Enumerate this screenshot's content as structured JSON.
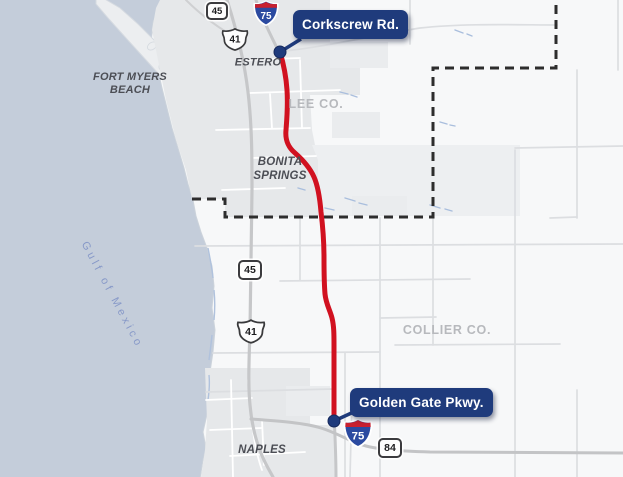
{
  "map": {
    "region": {
      "water_label": "Gulf of Mexico",
      "cities": [
        {
          "id": "fort-myers-beach",
          "line1": "FORT MYERS",
          "line2": "BEACH"
        },
        {
          "id": "estero",
          "line1": "ESTERO"
        },
        {
          "id": "bonita-springs",
          "line1": "BONITA",
          "line2": "SPRINGS"
        },
        {
          "id": "naples",
          "line1": "NAPLES"
        }
      ],
      "counties": [
        {
          "id": "lee",
          "label": "LEE CO."
        },
        {
          "id": "collier",
          "label": "COLLIER CO."
        }
      ]
    },
    "route": {
      "name": "I-75",
      "endpoints": [
        {
          "id": "north",
          "label": "Corkscrew Rd."
        },
        {
          "id": "south",
          "label": "Golden Gate Pkwy."
        }
      ]
    },
    "shields": {
      "sr45_north": "45",
      "i75_north": "75",
      "us41_north": "41",
      "sr45_mid": "45",
      "us41_mid": "41",
      "i75_south": "75",
      "sr84": "84"
    },
    "colors": {
      "route_red": "#d11120",
      "callout_navy": "#1f3b7c",
      "water_blue": "#c4cdda",
      "urban_gray": "#e6e8ea",
      "county_boundary_black": "#2d2d2d"
    }
  }
}
